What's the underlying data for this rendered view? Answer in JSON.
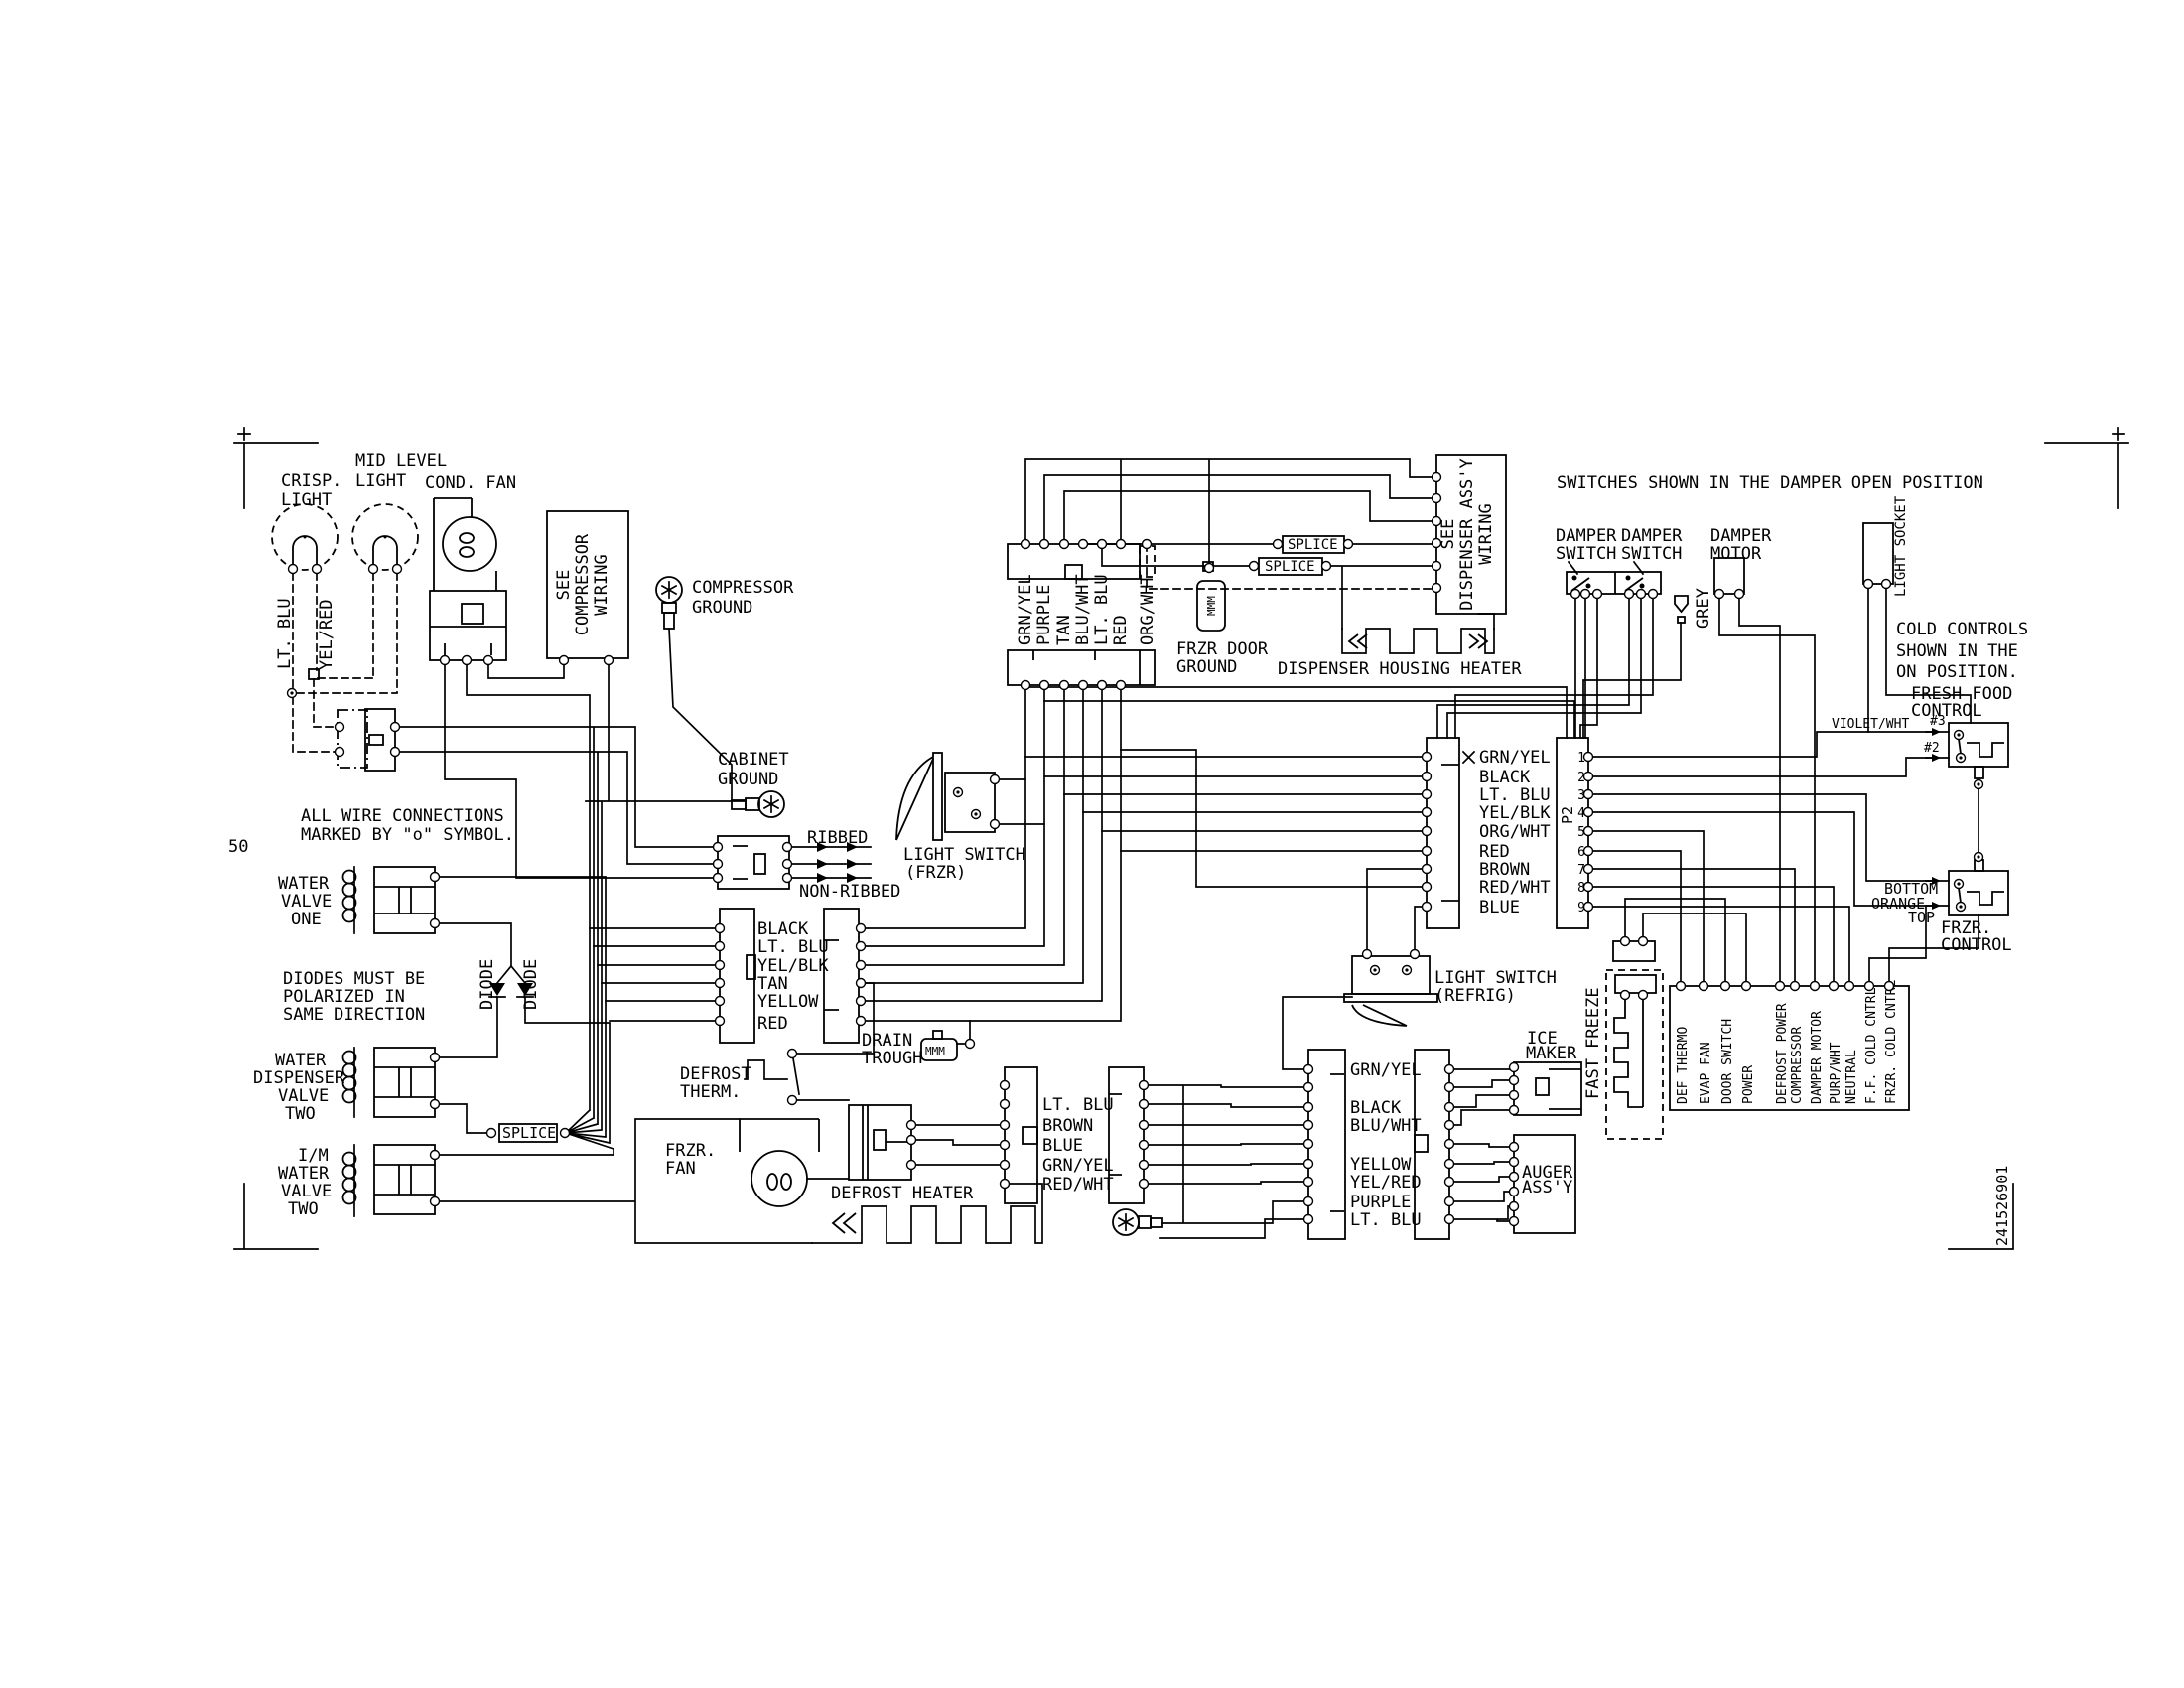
{
  "diagram": {
    "page_number": "50",
    "part_number": "241526901",
    "notes": {
      "wire_connections": [
        "ALL WIRE CONNECTIONS",
        "MARKED BY \"o\" SYMBOL."
      ],
      "diodes": [
        "DIODES MUST BE",
        "POLARIZED IN",
        "SAME DIRECTION"
      ],
      "switches": "SWITCHES SHOWN IN THE DAMPER OPEN POSITION",
      "cold_controls": [
        "COLD CONTROLS",
        "SHOWN IN THE",
        "ON POSITION."
      ]
    },
    "components": {
      "crisp_light": [
        "CRISP.",
        "LIGHT"
      ],
      "mid_level_light": [
        "MID LEVEL",
        "LIGHT"
      ],
      "cond_fan": "COND. FAN",
      "see_compressor_wiring": [
        "SEE",
        "COMPRESSOR",
        "WIRING"
      ],
      "compressor_ground": [
        "COMPRESSOR",
        "GROUND"
      ],
      "cabinet_ground": [
        "CABINET",
        "GROUND"
      ],
      "water_valve_one": [
        "WATER",
        "VALVE",
        "ONE"
      ],
      "water_dispenser_valve_two": [
        "WATER",
        "DISPENSER",
        "VALVE",
        "TWO"
      ],
      "im_water_valve_two": [
        "I/M",
        "WATER",
        "VALVE",
        "TWO"
      ],
      "diode": "DIODE",
      "splice": "SPLICE",
      "ribbed": "RIBBED",
      "non_ribbed": "NON-RIBBED",
      "light_switch_frzr": [
        "LIGHT SWITCH",
        "(FRZR)"
      ],
      "light_switch_refrig": [
        "LIGHT SWITCH",
        "(REFRIG)"
      ],
      "drain_trough": [
        "DRAIN",
        "TROUGH"
      ],
      "defrost_therm": [
        "DEFROST",
        "THERM."
      ],
      "frzr_fan": [
        "FRZR.",
        "FAN"
      ],
      "defrost_heater": "DEFROST HEATER",
      "frzr_door_ground": [
        "FRZR DOOR",
        "GROUND"
      ],
      "see_dispenser_assy": [
        "SEE",
        "DISPENSER ASS'Y",
        "WIRING"
      ],
      "dispenser_housing_heater": "DISPENSER HOUSING HEATER",
      "ice_maker": [
        "ICE",
        "MAKER"
      ],
      "auger_assy": [
        "AUGER",
        "ASS'Y"
      ],
      "fast_freeze": "FAST FREEZE",
      "damper_switch": [
        "DAMPER",
        "SWITCH"
      ],
      "damper_motor": [
        "DAMPER",
        "MOTOR"
      ],
      "grey": "GREY",
      "light_socket": "LIGHT SOCKET",
      "fresh_food_control": [
        "FRESH FOOD",
        "CONTROL"
      ],
      "frzr_control": [
        "FRZR.",
        "CONTROL"
      ],
      "mmm": "MMM",
      "pin3": "#3",
      "pin2": "#2",
      "bottom": "BOTTOM",
      "orange": "ORANGE",
      "top": "TOP",
      "violet_wht": "VIOLET/WHT",
      "p2": "P2"
    },
    "wire_labels": {
      "lt_blu": "LT. BLU",
      "yel_red": "YEL/RED",
      "top_connector": [
        "GRN/YEL",
        "PURPLE",
        "TAN",
        "BLU/WHT",
        "LT. BLU",
        "RED",
        "ORG/WHT"
      ],
      "center_connector": [
        "BLACK",
        "LT. BLU",
        "YEL/BLK",
        "TAN",
        "YELLOW",
        "RED"
      ],
      "mid_right_connector": [
        "GRN/YEL",
        "BLACK",
        "LT. BLU",
        "YEL/BLK",
        "ORG/WHT",
        "RED",
        "BROWN",
        "RED/WHT",
        "BLUE"
      ],
      "bottom_center_connector": [
        "LT. BLU",
        "BROWN",
        "BLUE",
        "GRN/YEL",
        "RED/WHT"
      ],
      "bottom_right_connector": [
        "GRN/YEL",
        "BLACK",
        "BLU/WHT",
        "YELLOW",
        "YEL/RED",
        "PURPLE",
        "LT. BLU"
      ]
    },
    "p2_pins": [
      "1",
      "2",
      "3",
      "4",
      "5",
      "6",
      "7",
      "8",
      "9"
    ],
    "terminal_block": [
      "DEF THERMO",
      "EVAP FAN",
      "DOOR SWITCH",
      "POWER",
      "DEFROST POWER",
      "COMPRESSOR",
      "DAMPER MOTOR",
      "PURP/WHT",
      "NEUTRAL",
      "F.F. COLD CNTRL",
      "FRZR. COLD CNTRL"
    ]
  }
}
